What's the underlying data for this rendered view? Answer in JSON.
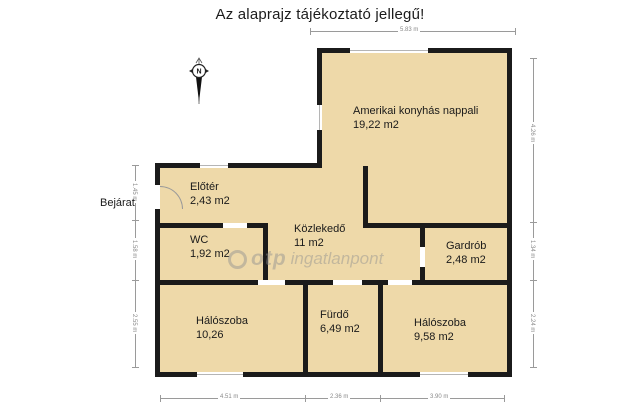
{
  "title": "Az alaprajz tájékoztató jellegű!",
  "entrance_label": "Bejárat",
  "compass": {
    "letter": "N"
  },
  "watermark": {
    "brand": "otp",
    "suffix": "ingatlanpont"
  },
  "rooms": {
    "living": {
      "name": "Amerikai konyhás nappali",
      "area": "19,22 m2"
    },
    "foyer": {
      "name": "Előtér",
      "area": "2,43 m2"
    },
    "wc": {
      "name": "WC",
      "area": "1,92 m2"
    },
    "hallway": {
      "name": "Közlekedő",
      "area": "11 m2"
    },
    "wardrobe": {
      "name": "Gardrób",
      "area": "2,48 m2"
    },
    "bedroom1": {
      "name": "Hálószoba",
      "area": "10,26"
    },
    "bathroom": {
      "name": "Fürdő",
      "area": "6,49 m2"
    },
    "bedroom2": {
      "name": "Hálószoba",
      "area": "9,58 m2"
    }
  },
  "dimensions": {
    "top": "5.83 m",
    "right": [
      "4.26 m",
      "1.34 m",
      "2.24 m"
    ],
    "left": [
      "1.45 m",
      "1.58 m",
      "2.55 m"
    ],
    "bottom": [
      "4.51 m",
      "2.36 m",
      "3.90 m"
    ]
  },
  "colors": {
    "room_fill": "#eed9a9",
    "wall": "#1b1b1b",
    "dimension": "#9a9a9a",
    "watermark": "#8f8f8f"
  }
}
